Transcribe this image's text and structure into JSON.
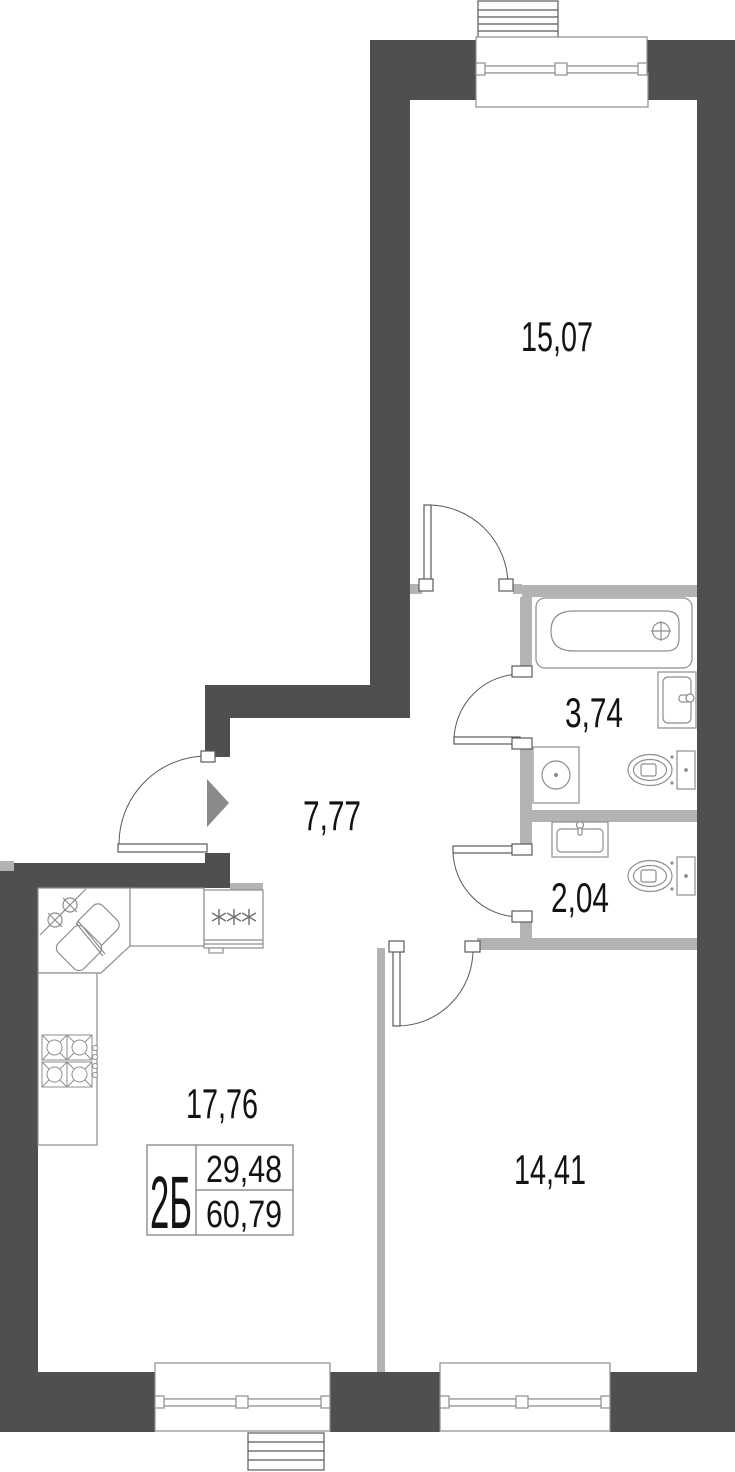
{
  "plan": {
    "kind": "apartment-floor-plan",
    "unit_card": {
      "type_label": "2Б",
      "value_top": "29,48",
      "value_bottom": "60,79"
    },
    "rooms": {
      "bedroom_top": {
        "area": "15,07"
      },
      "bathroom": {
        "area": "3,74"
      },
      "hallway": {
        "area": "7,77"
      },
      "wc": {
        "area": "2,04"
      },
      "kitchen_living": {
        "area": "17,76"
      },
      "bedroom_bottom": {
        "area": "14,41"
      }
    },
    "fixtures": [
      "bathtub-icon",
      "washbasin-icon",
      "toilet-icon",
      "washing-machine-icon",
      "corner-sink-icon",
      "stove-icon",
      "fridge-icon",
      "entrance-arrow-icon",
      "window-icon",
      "balcony-door-icon",
      "door-swing-icon"
    ],
    "colors": {
      "wall_dark": "#4f4f4f",
      "wall_light": "#b3b3b3",
      "fixture_line": "#8e8e8e",
      "door_line": "#5a5a5a",
      "arrow": "#8a8a8a",
      "text": "#131313"
    }
  }
}
